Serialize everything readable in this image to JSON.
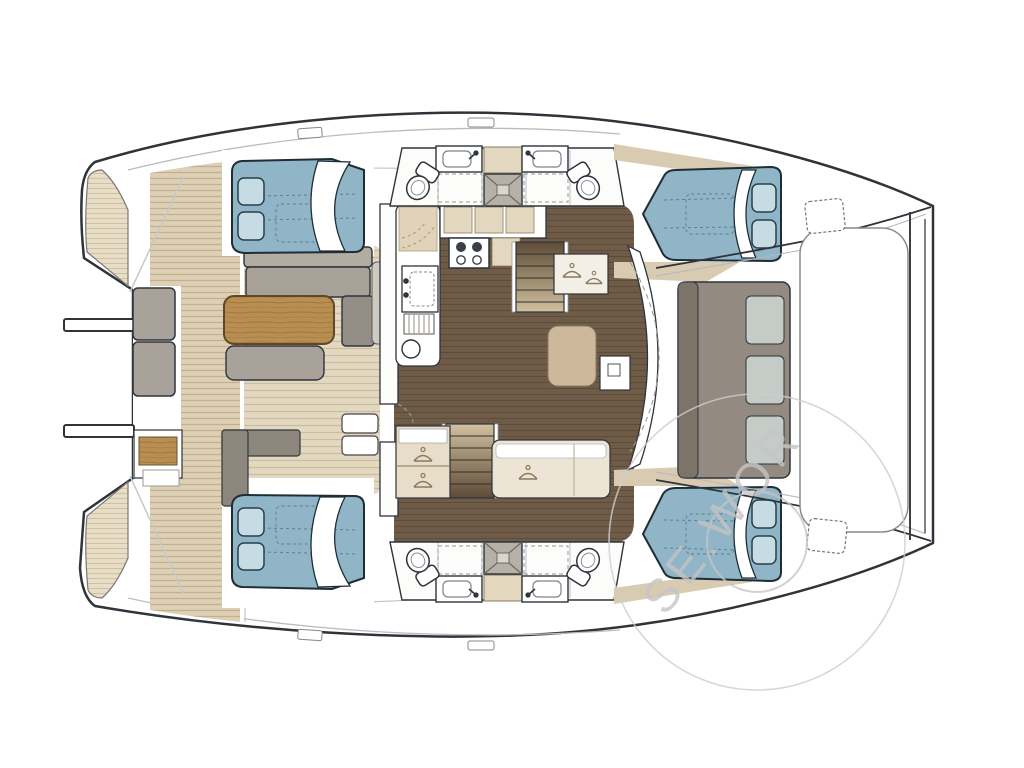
{
  "watermark": {
    "text": "SE.WOR",
    "color": "#c5c5c5"
  },
  "palette": {
    "hull_outline": "#2e343a",
    "bed_blue": "#8fb5c7",
    "pillow_blue": "#c6dce5",
    "teak_deck": "#e3d8c1",
    "teak_stripe": "#cdbc9e",
    "salon_floor": "#6f5c48",
    "table_wood": "#b98e52",
    "cushion_gray": "#a7a198",
    "bench_taupe": "#938b81",
    "counter_beige": "#e3d7bf"
  },
  "icons": {
    "toilet": "toilet-icon",
    "sink": "sink-icon",
    "shower": "shower-pan-icon",
    "stove": "stove-icon",
    "hanger": "hanger-icon",
    "anchor_hatch": "anchor-hatch-icon",
    "bed": "double-berth"
  }
}
